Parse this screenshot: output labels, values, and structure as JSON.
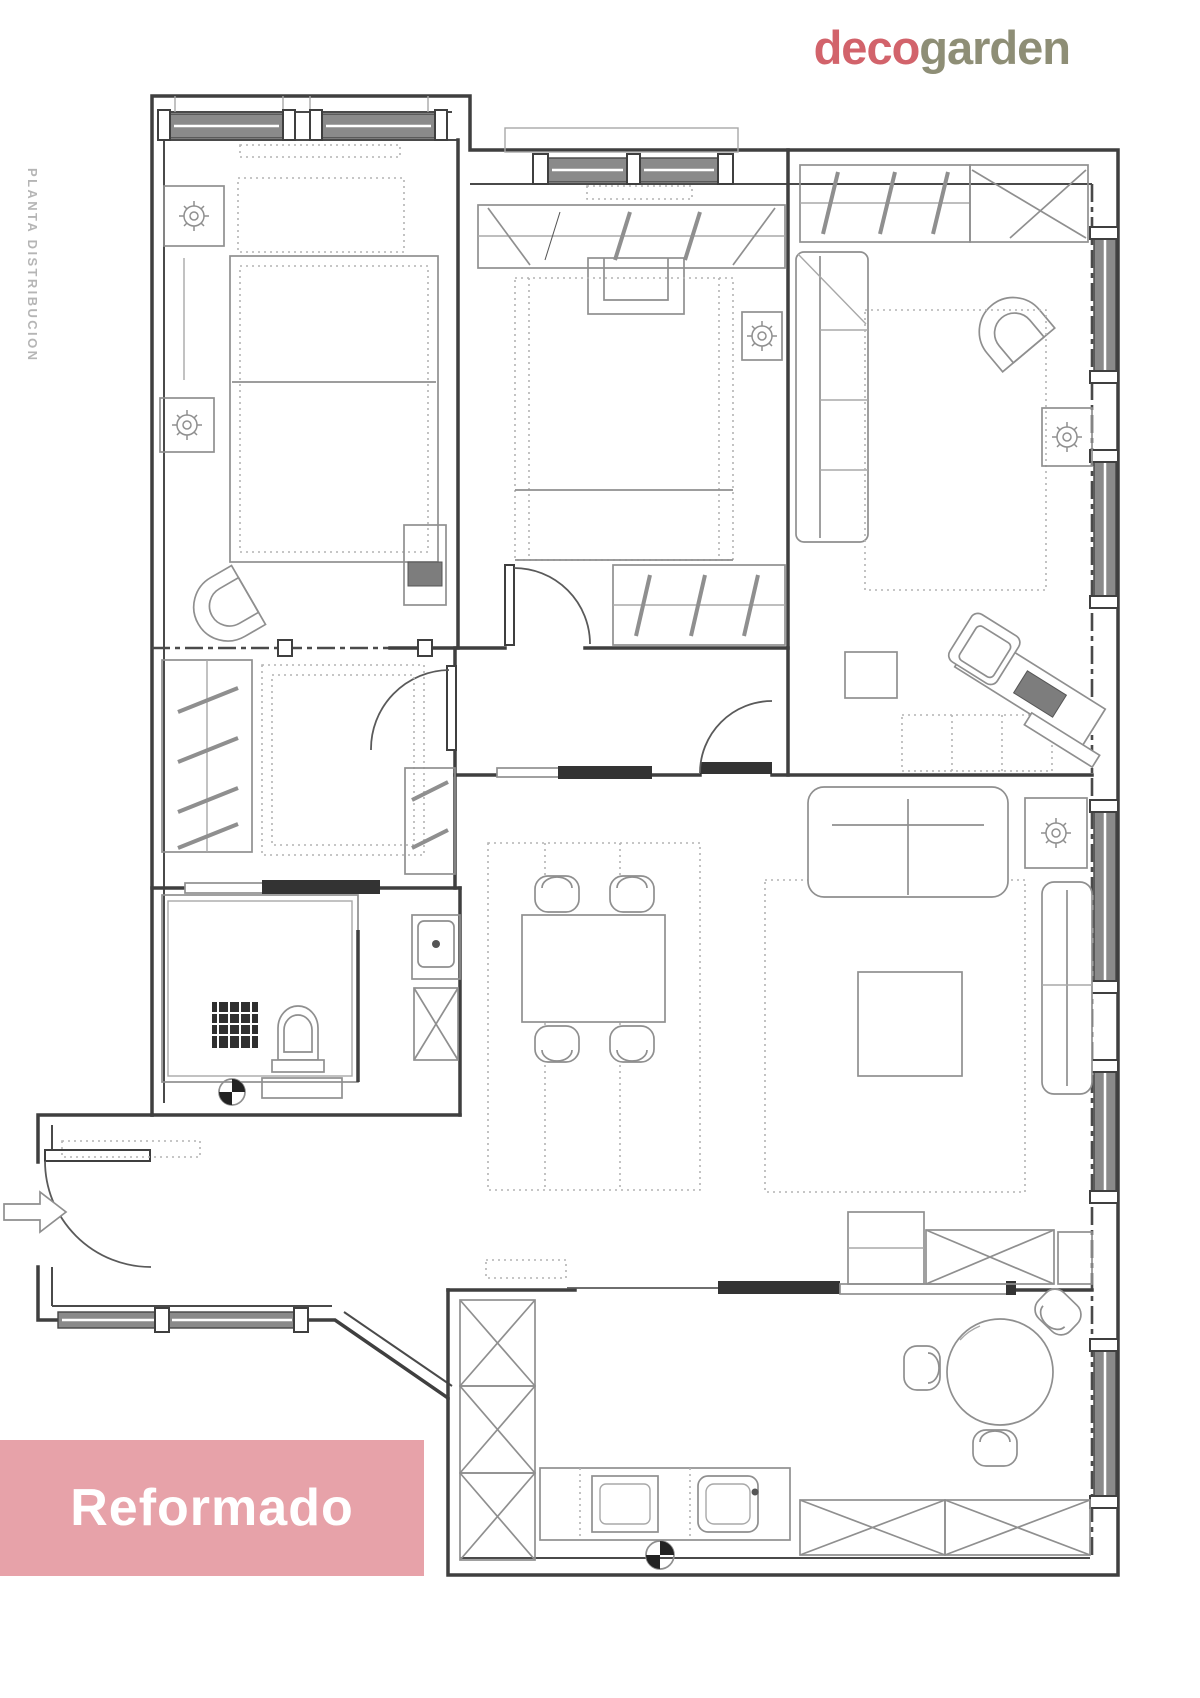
{
  "logo": {
    "part1": "deco",
    "part2": "garden",
    "part1_color": "#d2636b",
    "part2_color": "#8e8e76"
  },
  "side_label": "PLANTA DISTRIBUCION",
  "stamp": {
    "label": "Reformado",
    "bg_color": "#e7a2a9",
    "text_color": "#ffffff"
  },
  "plan": {
    "type": "apartment-floor-plan",
    "state": "reformed-layout",
    "line_color": "#3f3f3f",
    "furniture_color": "#8f8f8f",
    "elements": [
      "exterior-walls",
      "interior-walls",
      "windows",
      "hinged-doors",
      "sliding-doors",
      "entry-arrow",
      "double-bed",
      "double-bed-2",
      "single-bed",
      "wardrobe-hanging-rails",
      "closet-shelves",
      "nightstand-lamps",
      "armchairs",
      "daybed-sofa",
      "living-sofa",
      "chaise-longue",
      "coffee-table",
      "side-table-lamp",
      "tv-sideboard",
      "desk",
      "desk-chair",
      "laptop",
      "dining-table-4-chairs",
      "round-table-3-chairs",
      "kitchen-tall-cabinets",
      "kitchen-counter",
      "sink",
      "cooktop",
      "x-storage-units",
      "shower-tray",
      "shower-drain",
      "toilet",
      "washbasin",
      "rugs-dotted",
      "section-markers"
    ]
  }
}
